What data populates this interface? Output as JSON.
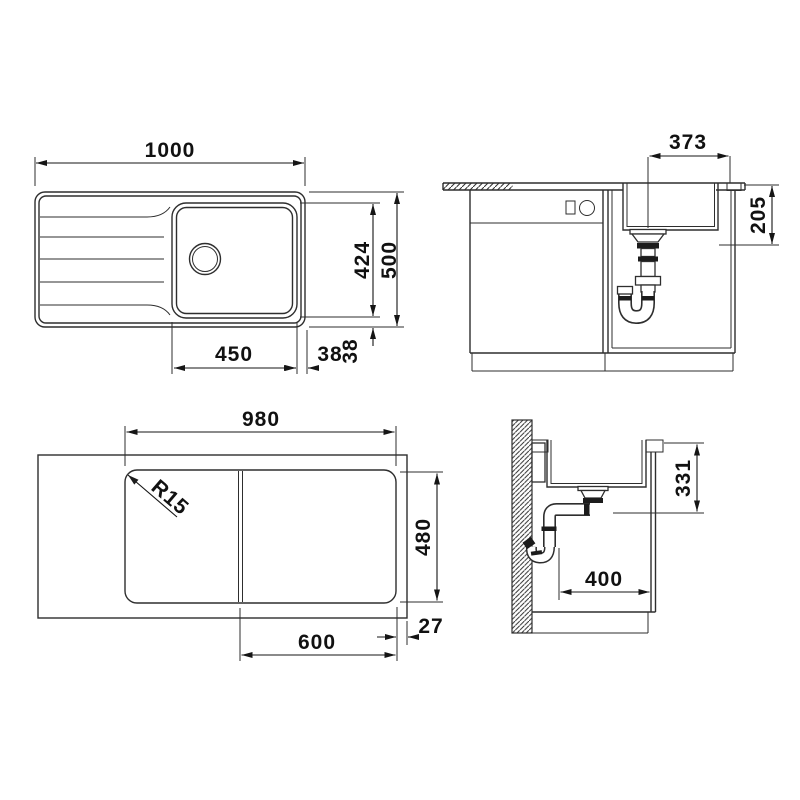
{
  "drawing": {
    "title": "sink-installation-drawing",
    "top_view": {
      "overall_width": "1000",
      "bowl_length": "424",
      "overall_depth": "500",
      "bowl_width": "450",
      "side_gap": "38",
      "back_gap": "38"
    },
    "front_section": {
      "drain_to_right_edge": "373",
      "bowl_depth": "205"
    },
    "underside_view": {
      "body_width": "980",
      "body_depth": "480",
      "board_width": "600",
      "edge_offset": "27",
      "corner_radius": "R15"
    },
    "side_section": {
      "drain_outlet_height": "331",
      "pipe_clearance": "400"
    },
    "colors": {
      "line": "#2e2e2e",
      "text": "#111111",
      "background": "#ffffff"
    }
  }
}
